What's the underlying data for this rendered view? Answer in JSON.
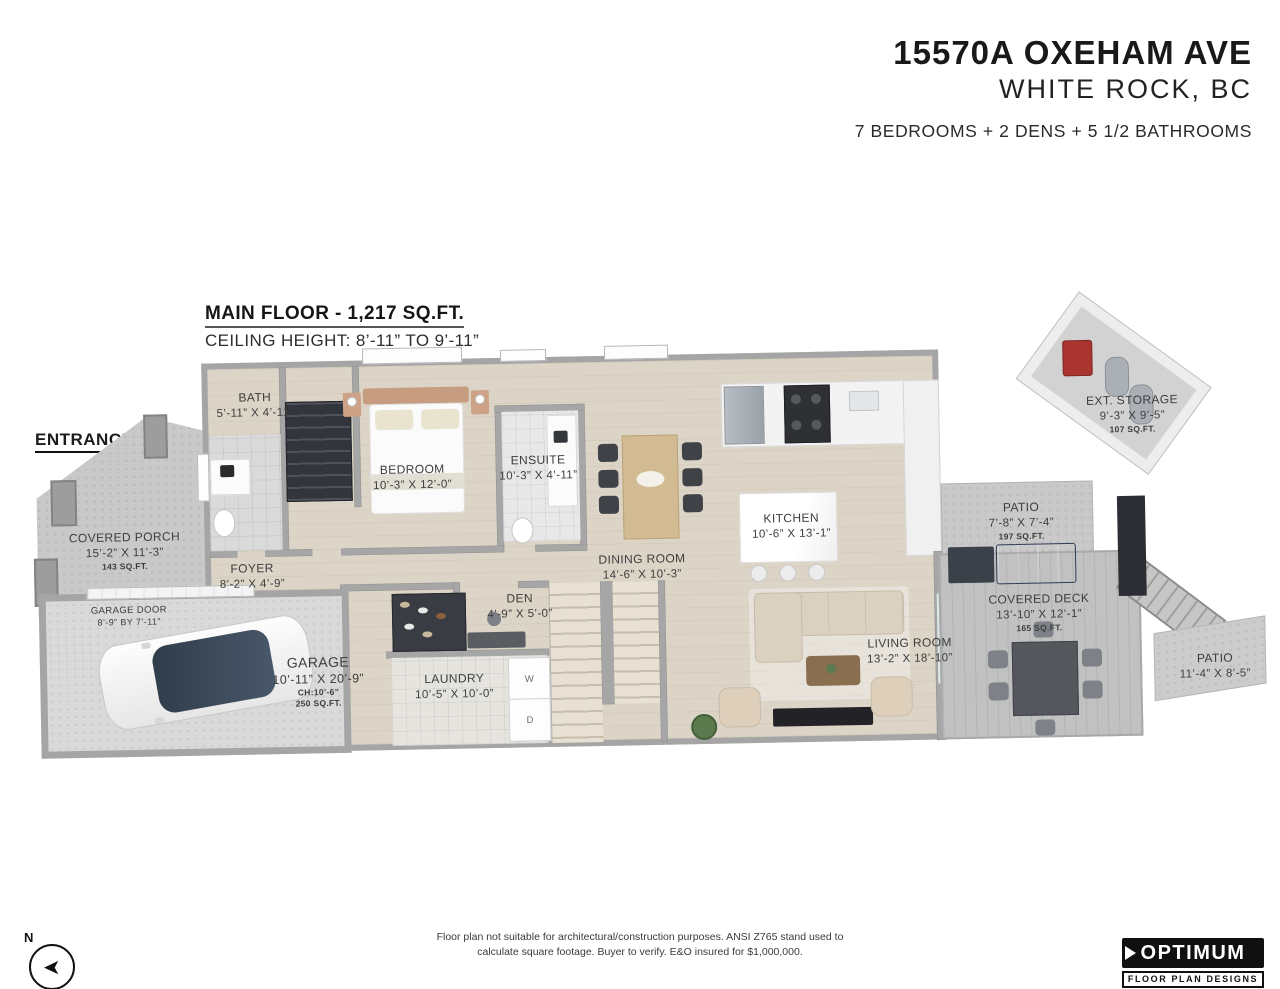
{
  "header": {
    "address_line1": "15570A OXEHAM AVE",
    "address_line2": "WHITE ROCK, BC",
    "summary": "7 BEDROOMS + 2 DENS + 5 1/2 BATHROOMS"
  },
  "floor_info": {
    "title": "MAIN FLOOR - 1,217 SQ.FT.",
    "ceiling": "CEILING HEIGHT: 8’-11” TO 9’-11”"
  },
  "entrance_label": "ENTRANCE",
  "rooms": {
    "bath": {
      "name": "BATH",
      "dims": "5’-11” X 4’-11”"
    },
    "bedroom": {
      "name": "BEDROOM",
      "dims": "10’-3” X 12’-0”"
    },
    "ensuite": {
      "name": "ENSUITE",
      "dims": "10’-3” X 4’-11”"
    },
    "dining": {
      "name": "DINING ROOM",
      "dims": "14’-6” X 10’-3”"
    },
    "kitchen": {
      "name": "KITCHEN",
      "dims": "10’-6” X 13’-1”"
    },
    "ext_storage": {
      "name": "EXT. STORAGE",
      "dims": "9’-3” X 9’-5”",
      "area": "107 SQ.FT."
    },
    "covered_porch": {
      "name": "COVERED PORCH",
      "dims": "15’-2” X 11’-3”",
      "area": "143 SQ.FT."
    },
    "foyer": {
      "name": "FOYER",
      "dims": "8’-2” X 4’-9”"
    },
    "garage_door": {
      "name": "GARAGE DOOR",
      "dims": "8’-9” BY 7’-11”"
    },
    "garage": {
      "name": "GARAGE",
      "dims": "10’-11” X 20’-9”",
      "ceiling": "CH:10’-6”",
      "area": "250 SQ.FT."
    },
    "den": {
      "name": "DEN",
      "dims": "4’-9” X 5’-0”"
    },
    "laundry": {
      "name": "LAUNDRY",
      "dims": "10’-5” X 10’-0”"
    },
    "patio_upper": {
      "name": "PATIO",
      "dims": "7’-8” X 7’-4”",
      "area": "197 SQ.FT."
    },
    "covered_deck": {
      "name": "COVERED DECK",
      "dims": "13’-10” X 12’-1”",
      "area": "165 SQ.FT."
    },
    "living": {
      "name": "LIVING ROOM",
      "dims": "13’-2” X 18’-10”"
    },
    "patio_lower": {
      "name": "PATIO",
      "dims": "11’-4” X 8’-5”"
    }
  },
  "appliances": {
    "washer_label": "W",
    "dryer_label": "D"
  },
  "compass": {
    "north": "N"
  },
  "footer": {
    "disclaimer_line1": "Floor plan not suitable for architectural/construction purposes. ANSI Z765 stand used to",
    "disclaimer_line2": "calculate square footage. Buyer to verify.  E&O insured for $1,000,000.",
    "logo_title": "OPTIMUM",
    "logo_subtitle": "FLOOR PLAN DESIGNS"
  },
  "colors": {
    "brand_black": "#111111",
    "wood_floor": "#dcd4c6",
    "concrete": "#c9c9c9",
    "deck_gray": "#c1c1c1",
    "wall_gray": "#a6a6a6",
    "accent_red": "#a93430",
    "bbq_blue": "#51669e"
  }
}
